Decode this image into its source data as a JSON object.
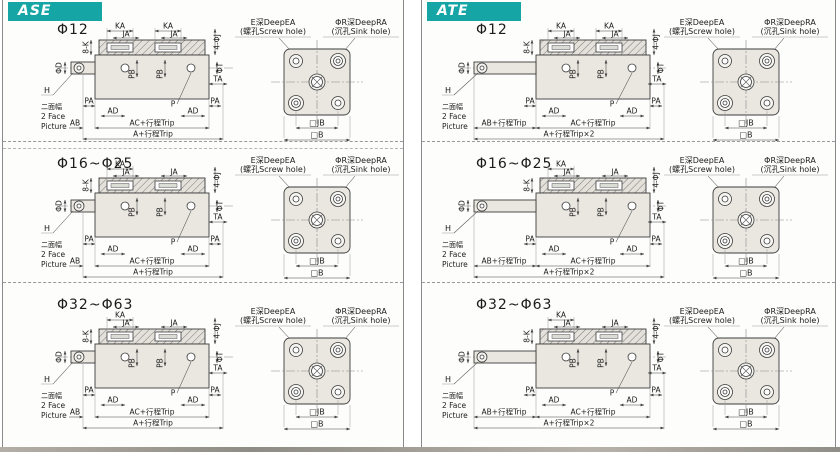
{
  "accent_color": "#16a5a5",
  "shared": {
    "ea1": "E深DeepEA",
    "ea2": "(螺孔Screw hole)",
    "ra1": "ΦR深DeepRA",
    "ra2": "(沉孔Sink hole)",
    "jb": "□JB",
    "b": "□B",
    "ka": "KA",
    "ja": "JA",
    "k8": "8-K",
    "j4": "4-ΦJ",
    "phiD": "ΦD",
    "phiT": "ΦT",
    "ta": "TA",
    "pa": "PA",
    "p": "P",
    "ad": "AD",
    "pb": "PB",
    "h": "H",
    "face_cn": "二面幅",
    "face_en1": "2 Face",
    "face_en2": "Picture"
  },
  "columns": [
    {
      "header": "ASE",
      "ab": "AB",
      "ac": "AC+行程Trip",
      "a": "A+行程Trip",
      "rows": [
        {
          "size": "Φ12",
          "ka2": "KA"
        },
        {
          "size": "Φ16~Φ25"
        },
        {
          "size": "Φ32~Φ63"
        }
      ]
    },
    {
      "header": "ATE",
      "ab": "AB+行程Trip",
      "ac": "AC+行程Trip",
      "a": "A+行程Trip×2",
      "rows": [
        {
          "size": "Φ12",
          "ka2": "KA"
        },
        {
          "size": "Φ16~Φ25"
        },
        {
          "size": "Φ32~Φ63"
        }
      ]
    }
  ]
}
